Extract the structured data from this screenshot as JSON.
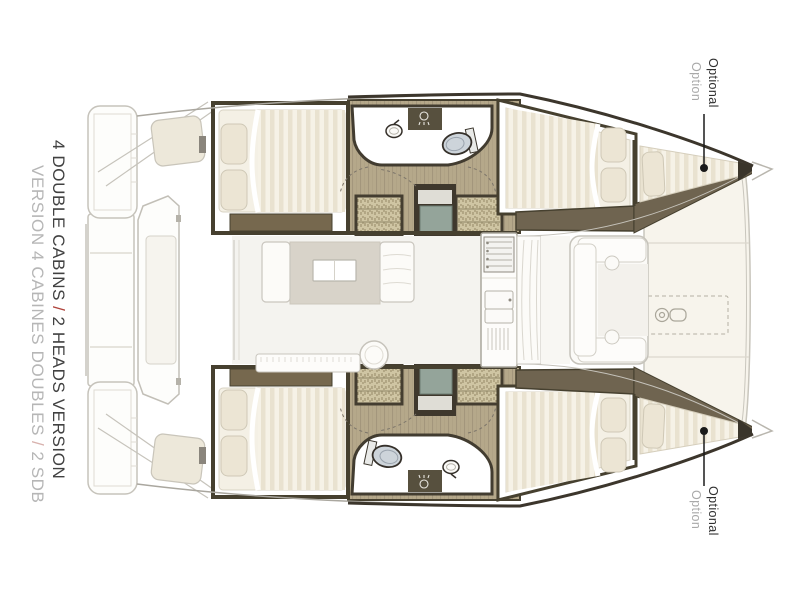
{
  "figure": {
    "subject": "catamaran interior layout plan, two hulls with four double cabins, two heads, saloon and galley"
  },
  "title": {
    "en": {
      "part1": "4 DOUBLE CABINS",
      "separator": "/",
      "part2": "2 HEADS VERSION"
    },
    "fr": {
      "part1": "VERSION 4 CABINES DOUBLES",
      "separator": "/",
      "part2": "2 SDB"
    }
  },
  "annotations": {
    "bow_top": {
      "label_en": "Optional",
      "label_fr": "Option"
    },
    "bow_bottom": {
      "label_en": "Optional",
      "label_fr": "Option"
    }
  },
  "colors": {
    "background": "#ffffff",
    "title_primary": "#414141",
    "title_separator_red": "#b0443c",
    "title_secondary": "#b6b6b6",
    "annotation_primary": "#2f2f2f",
    "annotation_secondary": "#a9a9a9",
    "hull_wall_dark": "#46402f",
    "trim_brown": "#6f6450",
    "wood_floor": "#b5a88a",
    "step_tread": "#cfc5a3",
    "bedding_stripe": "#e9e2d0",
    "mattress": "#f4f0e5",
    "toilet_gray": "#cdd4da",
    "companionway_step_teal": "#94a49a",
    "rug": "#d8d3c9",
    "deck_cream": "#f7f4ec",
    "outline_gray": "#c6c3bb"
  }
}
